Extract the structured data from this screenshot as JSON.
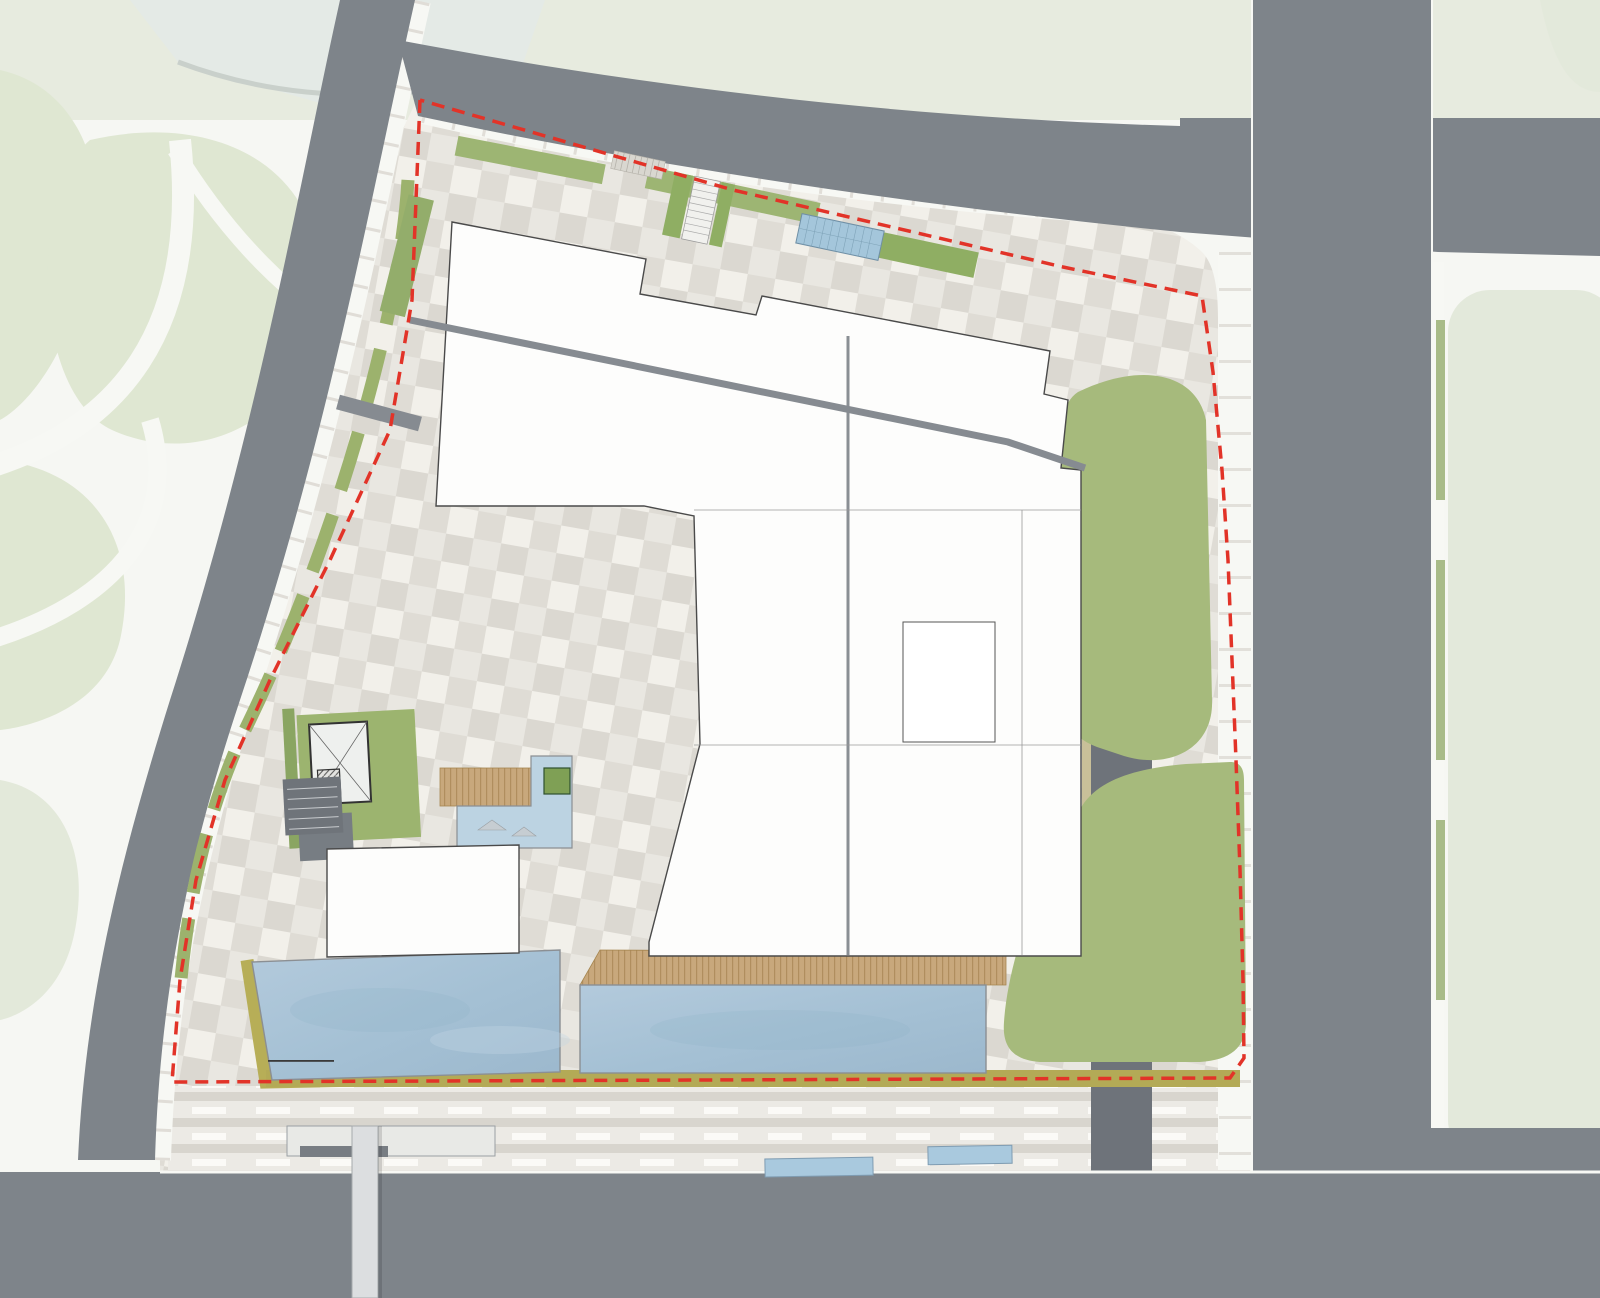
{
  "page": {
    "type": "architectural-site-plan",
    "description": "Cultural complex ground-floor site plan with surrounding roads, plaza, pools and green berms"
  },
  "plan": {
    "labels": [
      {
        "id": "label-library",
        "text": "24小时图书馆",
        "x": 585,
        "y": 266,
        "size": 8,
        "color": "#3a3a3a"
      },
      {
        "id": "label-exhibition",
        "text": "展厅",
        "x": 933,
        "y": 403,
        "size": 8,
        "color": "#3a3a3a"
      },
      {
        "id": "label-children",
        "text": "儿童阅览",
        "x": 567,
        "y": 458,
        "size": 8,
        "color": "#3a3a3a"
      },
      {
        "id": "label-culture-1",
        "text": "文化综合",
        "x": 783,
        "y": 472,
        "size": 8,
        "color": "#3a3a3a"
      },
      {
        "id": "label-culture-2",
        "text": "文化综合",
        "x": 764,
        "y": 582,
        "size": 8,
        "color": "#3a3a3a"
      },
      {
        "id": "label-culture-3",
        "text": "文化综合",
        "x": 729,
        "y": 687,
        "size": 8,
        "color": "#3a3a3a"
      },
      {
        "id": "label-public-lobby",
        "text": "公共门厅",
        "x": 413,
        "y": 900,
        "size": 8,
        "color": "#3a3a3a"
      },
      {
        "id": "label-culture-4",
        "text": "文化综合",
        "x": 958,
        "y": 911,
        "size": 8,
        "color": "#3a3a3a"
      },
      {
        "id": "label-ticket",
        "text": "售票处",
        "x": 737,
        "y": 948,
        "size": 7,
        "color": "#3a3a3a"
      },
      {
        "id": "label-bus-marking",
        "text": "公交车",
        "x": 893,
        "y": 1191,
        "size": 11,
        "color": "#f5f6f4"
      }
    ],
    "colors": {
      "site_boundary_red": "#e23328",
      "road_gray": "#7e848a",
      "dropoff_gray": "#6e737a",
      "water_blue": "#a9c4d8",
      "berm_green": "#a6ba7c",
      "median_green": "#a8b78f",
      "deck_tan": "#c8a87c",
      "plaza_light": "#e9e7e1",
      "plaza_dark": "#dbd8d1",
      "canopy_blue": "#a4c6db",
      "lawn_pale": "#e2e8d8"
    },
    "icons": {
      "tree": "tree-icon",
      "street_tree": "street-tree-icon",
      "car": "car-icon",
      "bus": "bus-icon",
      "person": "person-icon",
      "crosswalk": "crosswalk-stripes",
      "lane_arrow": "lane-arrow-icon",
      "bus_shelter": "bus-shelter-canopy",
      "metro_canopy": "metro-entrance-canopy",
      "glass_canopy": "glass-skylight-canopy",
      "elevator_core": "elevator-core",
      "stair": "stair-run"
    }
  }
}
